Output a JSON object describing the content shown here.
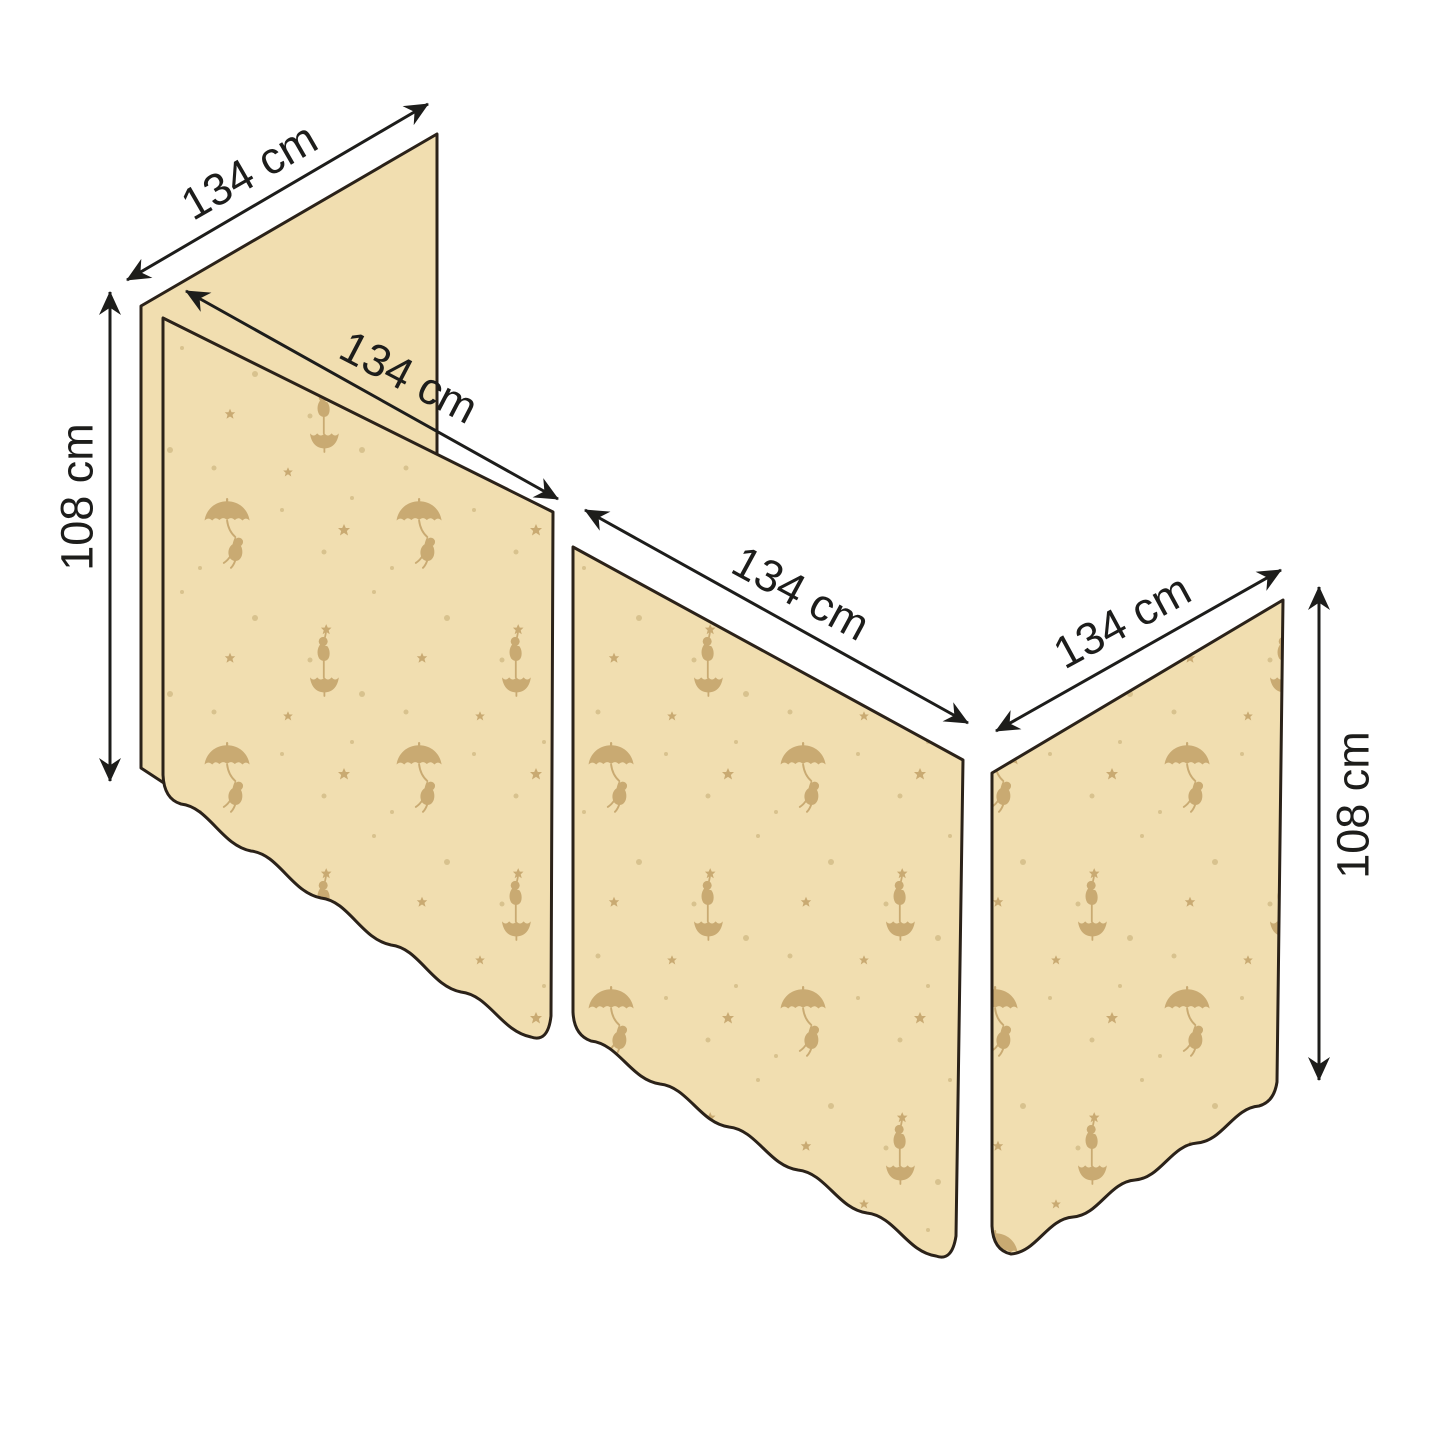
{
  "diagram": {
    "type": "product dimension diagram",
    "subject": "Three-panel bed curtain set with cherub and umbrella fabric pattern",
    "background": "#ffffff"
  },
  "colors": {
    "panel_fill": "#f1deb0",
    "pattern_motif": "#c9aa72",
    "pattern_dot": "#d8c28e",
    "panel_outline": "#2b2219",
    "dimension_ink": "#1d1d1b"
  },
  "panels": {
    "back": {
      "style": "plain",
      "width_label": "134 cm",
      "height_label": "108 cm"
    },
    "front_left": {
      "style": "patterned",
      "width_label": "134 cm"
    },
    "front_middle": {
      "style": "patterned",
      "width_label": "134 cm"
    },
    "right_side": {
      "style": "patterned",
      "width_label": "134 cm",
      "height_label": "108 cm"
    }
  },
  "dimension_labels": {
    "back_width": "134 cm",
    "front_left_width": "134 cm",
    "front_middle_width": "134 cm",
    "right_side_width": "134 cm",
    "left_height": "108 cm",
    "right_height": "108 cm"
  },
  "pattern_motifs": [
    "cherub hanging from umbrella",
    "cherub balancing on upturned umbrella with star",
    "small stars",
    "dots"
  ]
}
